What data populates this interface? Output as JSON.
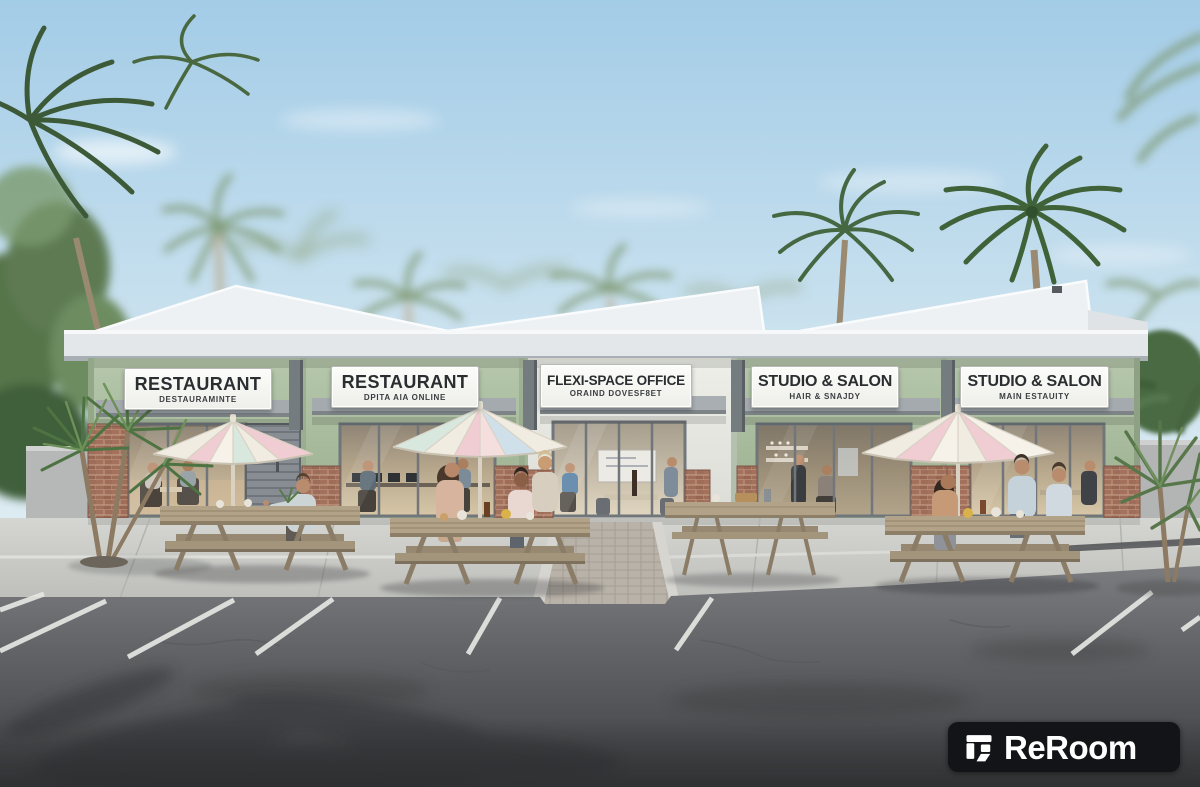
{
  "signs": [
    {
      "title": "RESTAURANT",
      "subtitle": "DESTAURAMINTE"
    },
    {
      "title": "RESTAURANT",
      "subtitle": "DPITA AIA ONLINE"
    },
    {
      "title": "FLEXI-SPACE OFFICE",
      "subtitle": "ORAIND DOVESF8ET"
    },
    {
      "title": "STUDIO & SALON",
      "subtitle": "HAIR & SNAJDY"
    },
    {
      "title": "STUDIO & SALON",
      "subtitle": "MAIN ESTAUITY"
    }
  ],
  "watermark": {
    "label": "ReRoom",
    "icon": "reroom-logo-icon",
    "background_color": "#131417",
    "text_color": "#ffffff"
  },
  "palette": {
    "sky_top": "#a3cce7",
    "sky_horizon": "#e9f1f4",
    "wall_green": "#aabfa0",
    "wall_white": "#e9eae5",
    "roof_fascia": "#e3e7e9",
    "awning_gray": "#a4aaae",
    "brick": "#9e6e5a",
    "glass_interior": "#c9b89b",
    "sidewalk": "#cdcec9",
    "asphalt": "#626366",
    "parking_line": "#e6e6e3",
    "umbrella_cream": "#f1ece2",
    "umbrella_pink": "#f0ccd3",
    "umbrella_mint": "#d8e8df",
    "umbrella_blue": "#cfe0ea",
    "wood_table": "#b2a388",
    "foliage_green": "#4c6b45"
  }
}
